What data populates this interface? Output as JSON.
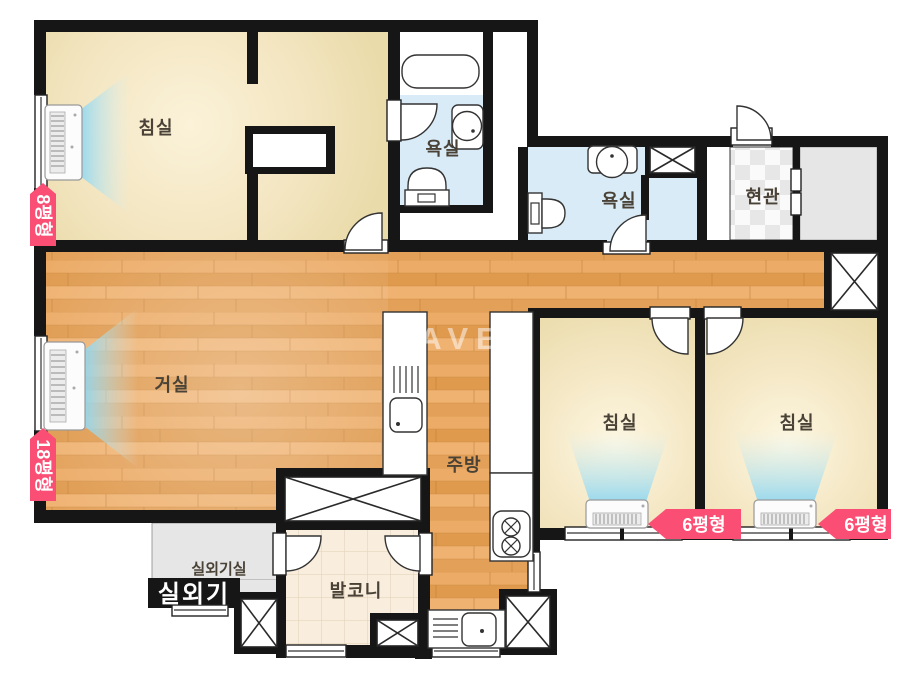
{
  "watermark": "NAVER",
  "colors": {
    "wall": "#161616",
    "wood_floor": "#e7a55e",
    "bedroom_floor": "#f1e3bb",
    "bath_floor": "#d9ebf6",
    "balcony_floor": "#f9eedd",
    "storage_gray": "#e6e6e6",
    "badge_pink": "#fb4e74",
    "ac_air_blue": "#8ed7f2",
    "label_text": "#4a4236"
  },
  "rooms": {
    "bedroom_main": {
      "label": "침실",
      "size_badge": "8평형"
    },
    "living": {
      "label": "거실",
      "size_badge": "18평형"
    },
    "bathroom_master": {
      "label": "욕실"
    },
    "bathroom_common": {
      "label": "욕실"
    },
    "entrance": {
      "label": "현관"
    },
    "kitchen": {
      "label": "주방"
    },
    "bedroom_right1": {
      "label": "침실",
      "size_badge": "6평형"
    },
    "bedroom_right2": {
      "label": "침실",
      "size_badge": "6평형"
    },
    "balcony": {
      "label": "발코니"
    },
    "outdoor_unit_room": {
      "label": "실외기실"
    },
    "outdoor_unit": {
      "label": "실외기"
    }
  }
}
